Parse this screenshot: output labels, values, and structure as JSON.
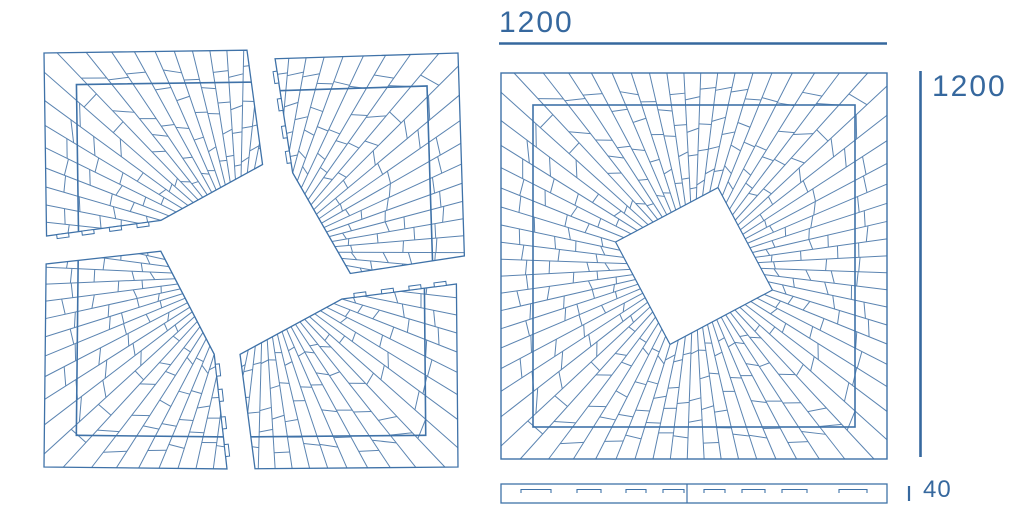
{
  "dimensions": {
    "width": {
      "label": "1200"
    },
    "height": {
      "label": "1200"
    },
    "thickness": {
      "label": "40"
    }
  },
  "drawing": {
    "colors": {
      "line": "#5b84b1",
      "border": "#3f72a8",
      "dimension": "#36689e",
      "background": "#ffffff"
    },
    "pattern": {
      "ray_count": 72,
      "diamond_rotation_deg": -28,
      "diamond_corner_radius": 82,
      "inner_border_inset": 32,
      "panel_size": 386,
      "explode_gap": 14,
      "cut_offset": 10
    }
  }
}
